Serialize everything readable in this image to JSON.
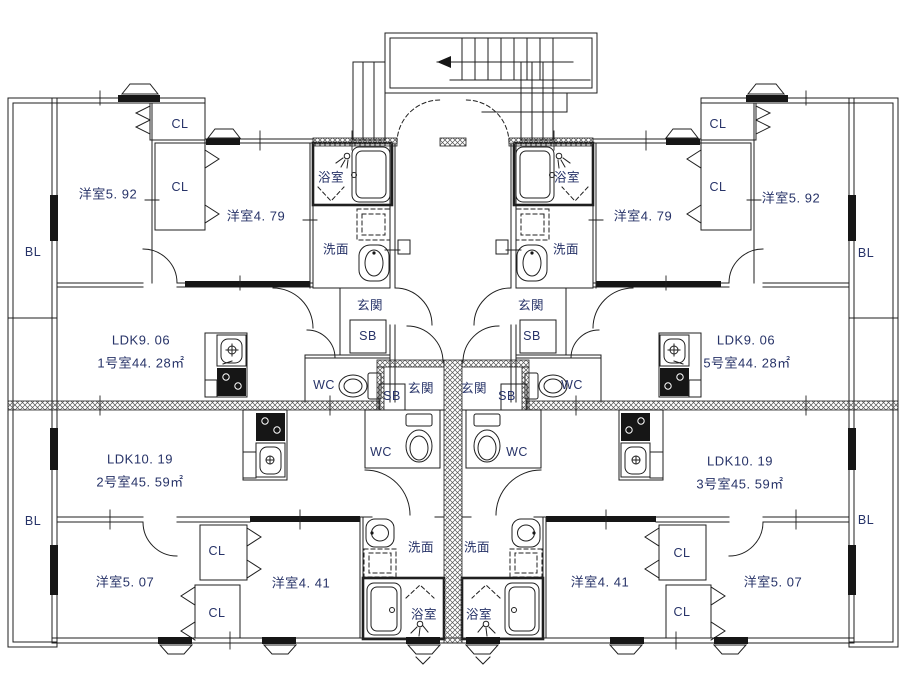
{
  "meta": {
    "drawing_type": "apartment-floor-plan",
    "units_shown": 4
  },
  "colors": {
    "label_text": "#273368",
    "line": "#1f1f1f",
    "wall_fill": "#161616",
    "background": "#ffffff"
  },
  "stairs": {
    "direction_arrow": "left"
  },
  "labels": {
    "common": [
      {
        "name": "balcony-label-nw",
        "text": "BL",
        "x": 33,
        "y": 252
      },
      {
        "name": "balcony-label-sw",
        "text": "BL",
        "x": 33,
        "y": 521
      },
      {
        "name": "balcony-label-ne",
        "text": "BL",
        "x": 866,
        "y": 253
      },
      {
        "name": "balcony-label-se",
        "text": "BL",
        "x": 866,
        "y": 520
      }
    ],
    "unit_1": [
      {
        "name": "u1-room-5-92",
        "text": "洋室5. 92",
        "x": 108,
        "y": 193,
        "big": true
      },
      {
        "name": "u1-closet-a",
        "text": "CL",
        "x": 180,
        "y": 124
      },
      {
        "name": "u1-closet-b",
        "text": "CL",
        "x": 180,
        "y": 187
      },
      {
        "name": "u1-room-4-79",
        "text": "洋室4. 79",
        "x": 256,
        "y": 215,
        "big": true
      },
      {
        "name": "u1-bathroom",
        "text": "浴室",
        "x": 331,
        "y": 176
      },
      {
        "name": "u1-washroom",
        "text": "洗面",
        "x": 336,
        "y": 248
      },
      {
        "name": "u1-entrance",
        "text": "玄関",
        "x": 370,
        "y": 304
      },
      {
        "name": "u1-shoebox",
        "text": "SB",
        "x": 368,
        "y": 336
      },
      {
        "name": "u1-wc",
        "text": "WC",
        "x": 324,
        "y": 385
      },
      {
        "name": "u1-ldk",
        "text": "LDK9. 06",
        "x": 141,
        "y": 340,
        "big": true
      },
      {
        "name": "u1-area",
        "text": "1号室44. 28㎡",
        "x": 141,
        "y": 362,
        "big": true
      }
    ],
    "unit_5": [
      {
        "name": "u5-bathroom",
        "text": "浴室",
        "x": 567,
        "y": 176
      },
      {
        "name": "u5-washroom",
        "text": "洗面",
        "x": 566,
        "y": 248
      },
      {
        "name": "u5-entrance",
        "text": "玄関",
        "x": 531,
        "y": 304
      },
      {
        "name": "u5-shoebox",
        "text": "SB",
        "x": 532,
        "y": 336
      },
      {
        "name": "u5-wc",
        "text": "WC",
        "x": 572,
        "y": 385
      },
      {
        "name": "u5-room-4-79",
        "text": "洋室4. 79",
        "x": 643,
        "y": 215,
        "big": true
      },
      {
        "name": "u5-closet-a",
        "text": "CL",
        "x": 718,
        "y": 124
      },
      {
        "name": "u5-closet-b",
        "text": "CL",
        "x": 718,
        "y": 187
      },
      {
        "name": "u5-room-5-92",
        "text": "洋室5. 92",
        "x": 791,
        "y": 197,
        "big": true
      },
      {
        "name": "u5-ldk",
        "text": "LDK9. 06",
        "x": 746,
        "y": 340,
        "big": true
      },
      {
        "name": "u5-area",
        "text": "5号室44. 28㎡",
        "x": 747,
        "y": 362,
        "big": true
      }
    ],
    "unit_2": [
      {
        "name": "u2-ldk",
        "text": "LDK10. 19",
        "x": 140,
        "y": 459,
        "big": true
      },
      {
        "name": "u2-area",
        "text": "2号室45. 59㎡",
        "x": 140,
        "y": 481,
        "big": true
      },
      {
        "name": "u2-entrance",
        "text": "玄関",
        "x": 421,
        "y": 387
      },
      {
        "name": "u2-shoebox",
        "text": "SB",
        "x": 392,
        "y": 396
      },
      {
        "name": "u2-wc",
        "text": "WC",
        "x": 381,
        "y": 452
      },
      {
        "name": "u2-washroom",
        "text": "洗面",
        "x": 421,
        "y": 546
      },
      {
        "name": "u2-bathroom",
        "text": "浴室",
        "x": 424,
        "y": 613
      },
      {
        "name": "u2-room-5-07",
        "text": "洋室5. 07",
        "x": 125,
        "y": 581,
        "big": true
      },
      {
        "name": "u2-closet-a",
        "text": "CL",
        "x": 217,
        "y": 551
      },
      {
        "name": "u2-closet-b",
        "text": "CL",
        "x": 217,
        "y": 613
      },
      {
        "name": "u2-room-4-41",
        "text": "洋室4. 41",
        "x": 301,
        "y": 582,
        "big": true
      }
    ],
    "unit_3": [
      {
        "name": "u3-entrance",
        "text": "玄関",
        "x": 474,
        "y": 387
      },
      {
        "name": "u3-shoebox",
        "text": "SB",
        "x": 507,
        "y": 396
      },
      {
        "name": "u3-wc",
        "text": "WC",
        "x": 517,
        "y": 452
      },
      {
        "name": "u3-washroom",
        "text": "洗面",
        "x": 477,
        "y": 546
      },
      {
        "name": "u3-bathroom",
        "text": "浴室",
        "x": 479,
        "y": 613
      },
      {
        "name": "u3-ldk",
        "text": "LDK10. 19",
        "x": 740,
        "y": 461,
        "big": true
      },
      {
        "name": "u3-area",
        "text": "3号室45. 59㎡",
        "x": 740,
        "y": 483,
        "big": true
      },
      {
        "name": "u3-room-4-41",
        "text": "洋室4. 41",
        "x": 600,
        "y": 581,
        "big": true
      },
      {
        "name": "u3-closet-a",
        "text": "CL",
        "x": 682,
        "y": 553
      },
      {
        "name": "u3-closet-b",
        "text": "CL",
        "x": 682,
        "y": 612
      },
      {
        "name": "u3-room-5-07",
        "text": "洋室5. 07",
        "x": 773,
        "y": 581,
        "big": true
      }
    ]
  }
}
